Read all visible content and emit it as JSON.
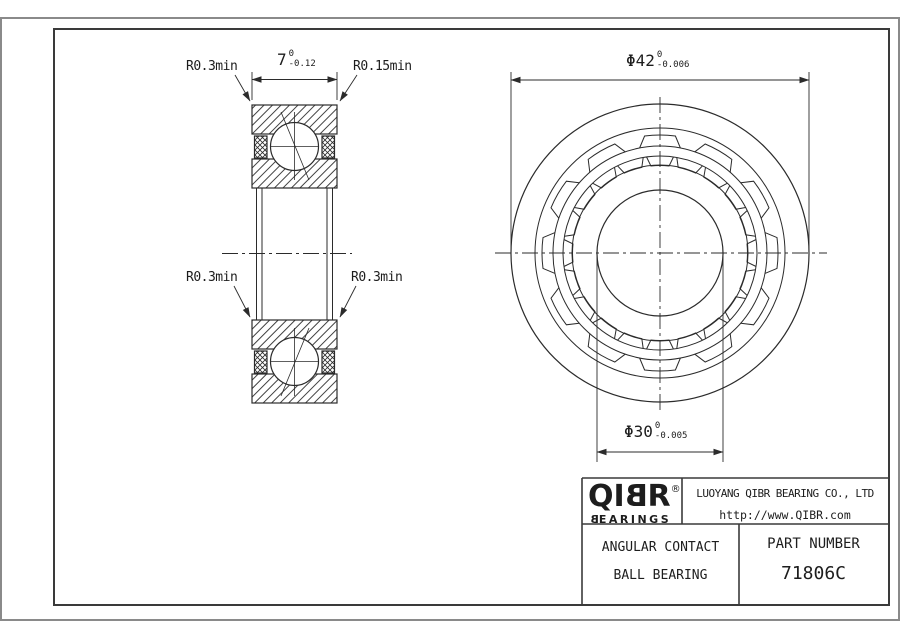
{
  "labels": {
    "fillet_top_left": "R0.3min",
    "fillet_top_right": "R0.15min",
    "fillet_mid_left": "R0.3min",
    "fillet_mid_right": "R0.3min"
  },
  "dimensions": {
    "width": {
      "value": "7",
      "tol_upper": "0",
      "tol_lower": "-0.12"
    },
    "outer_diameter": {
      "value": "Φ42",
      "tol_upper": "0",
      "tol_lower": "-0.006"
    },
    "bore_diameter": {
      "value": "Φ30",
      "tol_upper": "0",
      "tol_lower": "-0.005"
    }
  },
  "title_block": {
    "logo": {
      "part1": "QI",
      "part2": "B",
      "part3": "R",
      "registered": "®",
      "sub1": "B",
      "sub2": "EARINGS"
    },
    "company": "LUOYANG QIBR BEARING CO., LTD",
    "website": "http://www.QIBR.com",
    "product_line1": "ANGULAR CONTACT",
    "product_line2": "BALL BEARING",
    "part_number_label": "PART NUMBER",
    "part_number": "71806C"
  },
  "colors": {
    "line": "#2b2b2b",
    "frame": "#3a3a3a",
    "outer_border": "#8a8a8a"
  }
}
